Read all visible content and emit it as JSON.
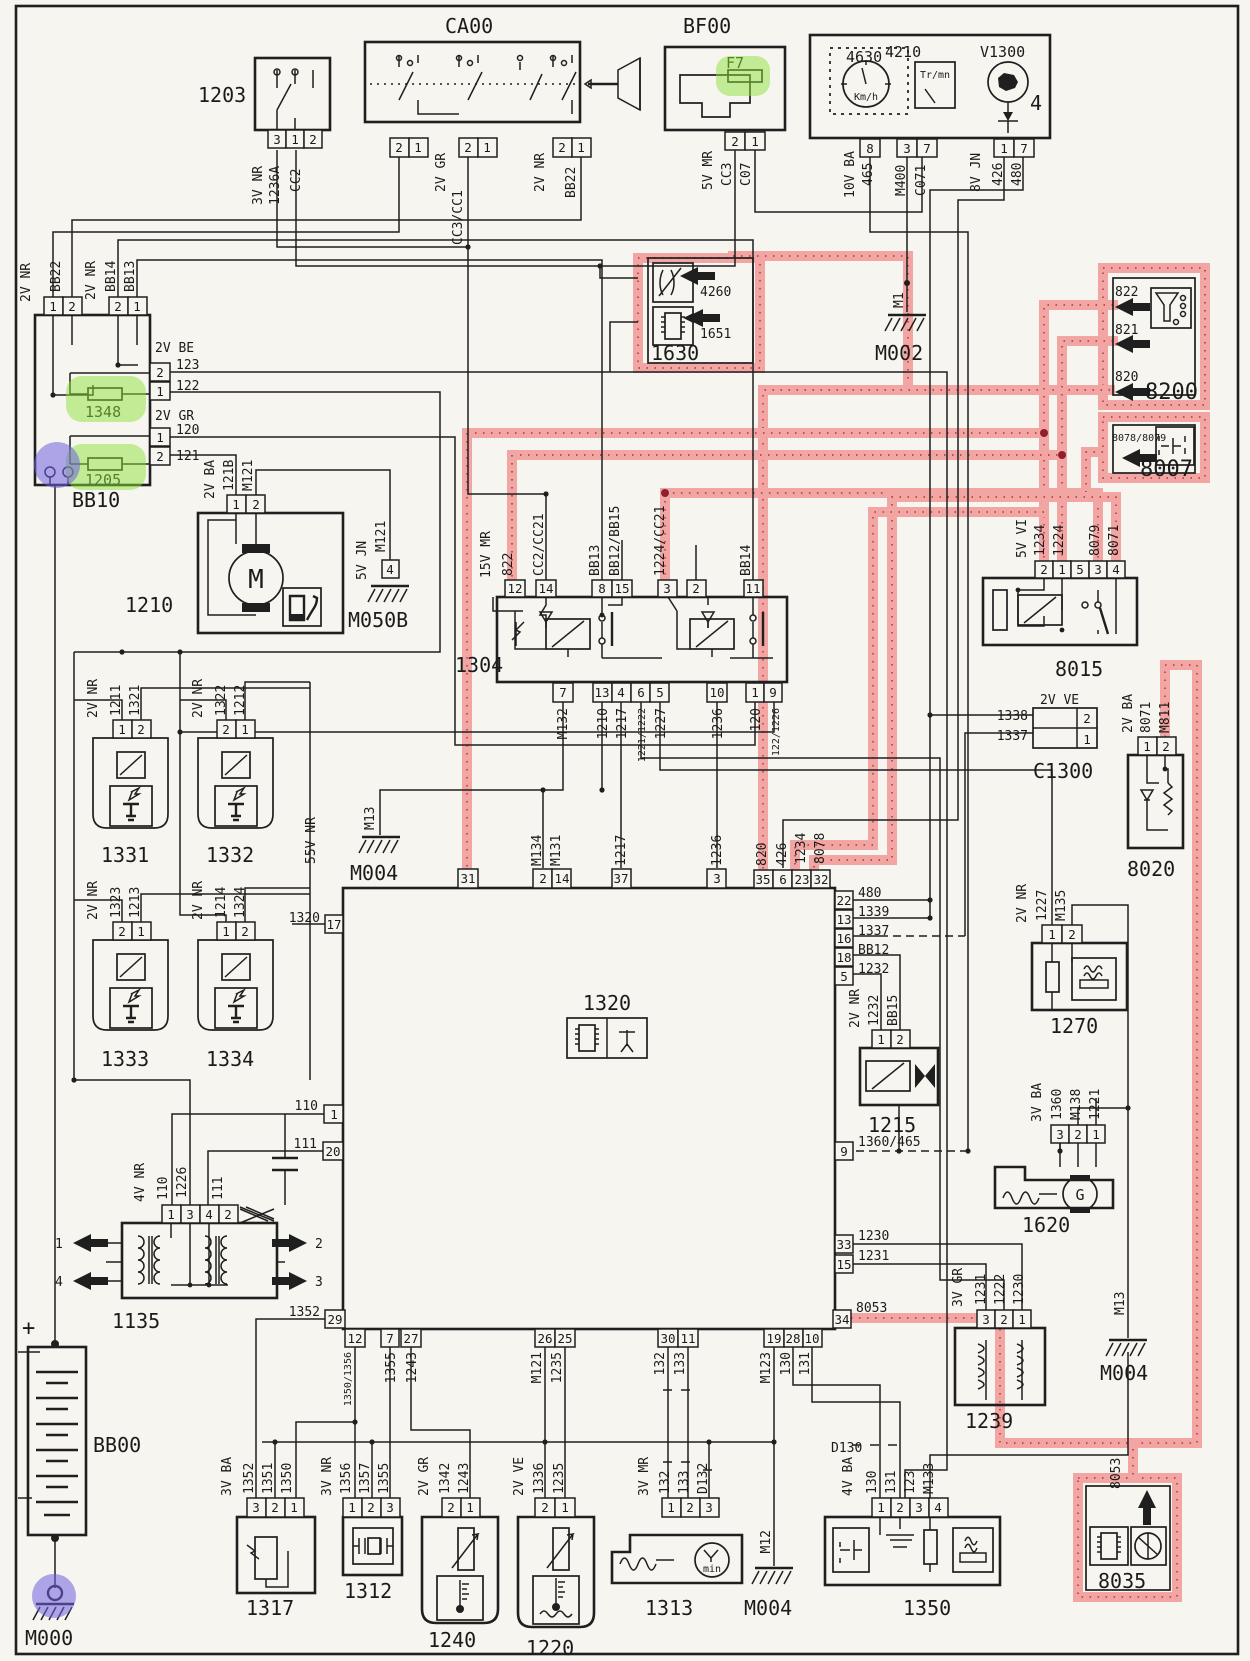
{
  "diagram": {
    "kind": "automotive wiring diagram",
    "sheet_number_visible": "4"
  },
  "colors": {
    "paper": "#f7f5ef",
    "ink": "#1f1f1f",
    "highlight_pink": "#f2a6a4",
    "highlight_red_dots": "#c04040",
    "highlight_green": "#8ee23c",
    "highlight_purple": "#6f61e0"
  },
  "t": {
    "p1": "1",
    "p2": "2",
    "p3": "3",
    "p4": "4",
    "p5": "5",
    "p6": "6",
    "p7": "7",
    "p8": "8",
    "p9": "9",
    "p10": "10",
    "p11": "11",
    "p12": "12",
    "p13": "13",
    "p14": "14",
    "p15": "15",
    "p16": "16",
    "p17": "17",
    "p18": "18",
    "p19": "19",
    "p20": "20",
    "p22": "22",
    "p23": "23",
    "p25": "25",
    "p26": "26",
    "p27": "27",
    "p28": "28",
    "p29": "29",
    "p30": "30",
    "p31": "31",
    "p32": "32",
    "p33": "33",
    "p34": "34",
    "p35": "35",
    "p37": "37",
    "c1203": "1203",
    "ca00": "CA00",
    "bf00": "BF00",
    "f7": "F7",
    "c4630": "4630",
    "c4210": "4210",
    "v1300": "V1300",
    "big4": "4",
    "trmn": "Tr/mn",
    "kmh": "Km/h",
    "c1630": "1630",
    "a4260": "4260",
    "a1651": "1651",
    "m002": "M002",
    "m1": "M1",
    "c8200": "8200",
    "a822": "822",
    "a821": "821",
    "a820": "820",
    "c8007": "8007",
    "a8078": "8078/8079",
    "bb10": "BB10",
    "f1348": "1348",
    "f1205": "1205",
    "c1210": "1210",
    "m050b": "M050B",
    "c1304": "1304",
    "c8015": "8015",
    "c1300": "C1300",
    "c8020": "8020",
    "m811": "M811",
    "c1331": "1331",
    "c1332": "1332",
    "c1333": "1333",
    "c1334": "1334",
    "c1320": "1320",
    "m004": "M004",
    "m13": "M13",
    "c1215": "1215",
    "c1270": "1270",
    "c1620": "1620",
    "c1239": "1239",
    "c1135": "1135",
    "bb00": "BB00",
    "m000": "M000",
    "plus": "+",
    "c1317": "1317",
    "c1312": "1312",
    "c1240": "1240",
    "c1220": "1220",
    "c1313": "1313",
    "c1350": "1350",
    "c8035": "8035",
    "w3vnr": "3V NR",
    "w1236a": "1236A",
    "cc2": "CC2",
    "w2vgr": "2V GR",
    "cc3cc1": "CC3/CC1",
    "w2vnr": "2V NR",
    "bb22": "BB22",
    "w5vmr": "5V MR",
    "cc3": "CC3",
    "c07": "C07",
    "w10vba": "10V BA",
    "n465": "465",
    "m400": "M400",
    "c071": "C071",
    "w8vjn": "8V JN",
    "n426": "426",
    "n480": "480",
    "bb14": "BB14",
    "bb13": "BB13",
    "w2vbe": "2V BE",
    "n123": "123",
    "n122": "122",
    "n120": "120",
    "n121": "121",
    "w2vba": "2V BA",
    "n121b": "121B",
    "m121": "M121",
    "w5vjn": "5V JN",
    "w15vmr": "15V MR",
    "cc2cc21": "CC2/CC21",
    "bb1215": "BB12/BB15",
    "n1224cc21": "1224/CC21",
    "m132": "M132",
    "n1217": "1217",
    "n12212": "1221/1222",
    "n1227": "1227",
    "n1236": "1236",
    "n12226": "122/1226",
    "w5vvi": "5V VI",
    "n1234": "1234",
    "n1224": "1224",
    "n8079": "8079",
    "n8071": "8071",
    "n1338": "1338",
    "n1337": "1337",
    "w2vve": "2V VE",
    "n1211": "1211",
    "n1321": "1321",
    "n1322": "1322",
    "n1212": "1212",
    "n1323": "1323",
    "n1213": "1213",
    "n1214": "1214",
    "n1324": "1324",
    "w55vnr": "55V NR",
    "m134": "M134",
    "m131": "M131",
    "n8078": "8078",
    "n1339": "1339",
    "bb12": "BB12",
    "n1232": "1232",
    "bb15": "BB15",
    "n1360465": "1360/465",
    "n1230": "1230",
    "n1231": "1231",
    "n8053": "8053",
    "w4vnr": "4V NR",
    "n110": "110",
    "n1226": "1226",
    "n111": "111",
    "n1352": "1352",
    "w3vba": "3V BA",
    "n1351": "1351",
    "n1350": "1350",
    "n13501356": "1350/1356",
    "n1356": "1356",
    "n1357": "1357",
    "n1355": "1355",
    "n1243": "1243",
    "n1342": "1342",
    "n1336": "1336",
    "n1235": "1235",
    "w3vmr": "3V MR",
    "n132": "132",
    "n133": "133",
    "d132": "D132",
    "m12": "M12",
    "m123": "M123",
    "n130": "130",
    "n131": "131",
    "d130": "D130",
    "w4vba": "4V BA",
    "m133": "M133",
    "w3vgr": "3V GR",
    "n1222": "1222",
    "n1221": "1221",
    "n1360": "1360",
    "m138": "M138",
    "m135": "M135",
    "gm": "G",
    "mm": "M",
    "xmin": "min"
  }
}
